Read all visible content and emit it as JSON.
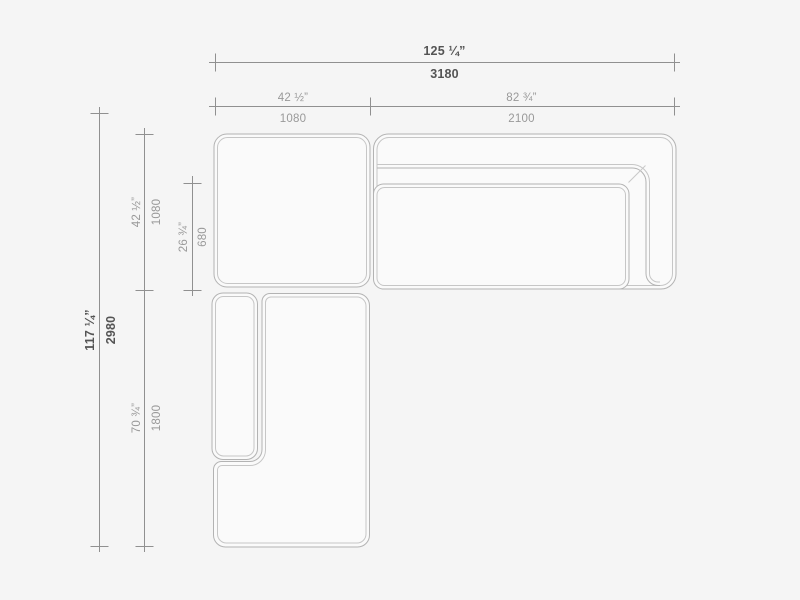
{
  "colors": {
    "background": "#f5f5f5",
    "piece_fill": "#fafafa",
    "outline": "#b3b3b3",
    "inner_line": "#c6c6c6",
    "dimension_line": "#909090",
    "dimension_text": "#999999",
    "dimension_text_emphasis": "#545454"
  },
  "dimensions": {
    "overall_width": {
      "inches": "125 ¼”",
      "mm": "3180"
    },
    "corner_width": {
      "inches": "42 ½”",
      "mm": "1080"
    },
    "right_width": {
      "inches": "82 ¾”",
      "mm": "2100"
    },
    "overall_depth": {
      "inches": "117 ¼”",
      "mm": "2980"
    },
    "corner_depth": {
      "inches": "42 ½”",
      "mm": "1080"
    },
    "seat_depth": {
      "inches": "26 ¾”",
      "mm": "680"
    },
    "chaise_depth": {
      "inches": "70 ¾”",
      "mm": "1800"
    }
  }
}
